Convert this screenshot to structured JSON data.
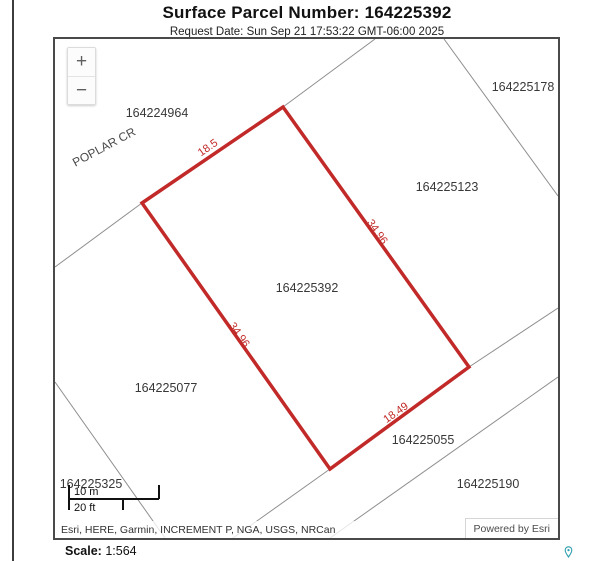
{
  "header": {
    "title": "Surface Parcel Number: 164225392",
    "request_date": "Request Date: Sun Sep 21 17:53:22 GMT-06:00 2025"
  },
  "map": {
    "zoom_in_label": "+",
    "zoom_out_label": "−",
    "street_label": "POPLAR CR",
    "highlight_color": "#c12a28",
    "highlighted_parcel": "164225392",
    "parcel_labels": [
      {
        "text": "164224964"
      },
      {
        "text": "164225178"
      },
      {
        "text": "164225123"
      },
      {
        "text": "164225392"
      },
      {
        "text": "164225077"
      },
      {
        "text": "164225055"
      },
      {
        "text": "164225190"
      },
      {
        "text": "164225325"
      }
    ],
    "dimension_labels": [
      {
        "text": "18.5"
      },
      {
        "text": "34.96"
      },
      {
        "text": "34.96"
      },
      {
        "text": "18.49"
      }
    ],
    "scalebar": {
      "metric": "10 m",
      "imperial": "20 ft"
    },
    "attribution": "Esri, HERE, Garmin, INCREMENT P, NGA, USGS, NRCan",
    "powered_by": "Powered by Esri"
  },
  "footer": {
    "scale_label": "Scale:",
    "scale_value": "1:564"
  }
}
